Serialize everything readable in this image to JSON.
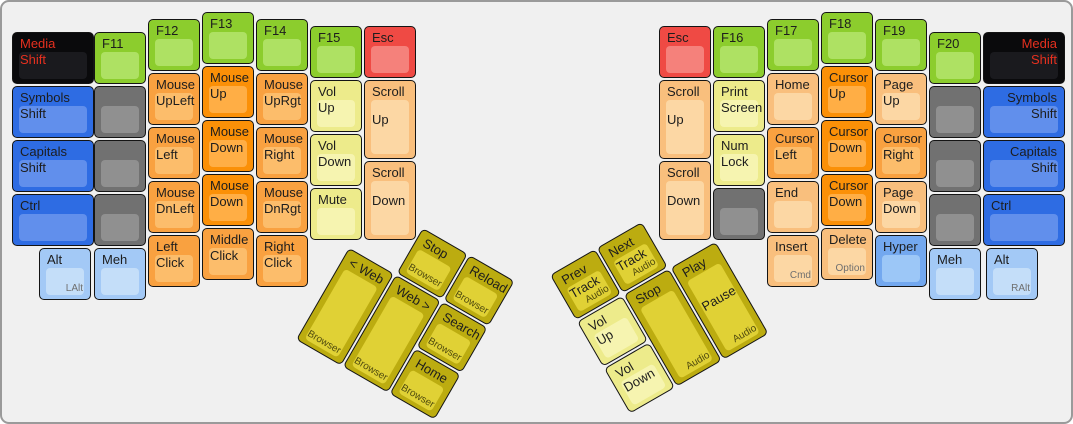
{
  "keyboard": {
    "description": "ErgoDox media/mouse layer keyboard layout",
    "frame": {
      "width": 1073,
      "height": 424,
      "background": "#f0f0f0",
      "border_color": "#9a9a9a"
    },
    "palette": {
      "black": {
        "base": "#0a0a0c",
        "top": "#1a1a1e",
        "text": "#e5301f"
      },
      "green": {
        "base": "#8ccd2d",
        "top": "#aee163"
      },
      "red": {
        "base": "#ef4a44",
        "top": "#f5817b"
      },
      "blue": {
        "base": "#2e6ce3",
        "top": "#618fec"
      },
      "hyper": {
        "base": "#73a8ef",
        "top": "#9cc7f7"
      },
      "lightblue": {
        "base": "#a3c9f6",
        "top": "#c4def9"
      },
      "gray": {
        "base": "#717171",
        "top": "#909090"
      },
      "orange": {
        "base": "#f9a140",
        "top": "#fcbd6b"
      },
      "orangeDeep": {
        "base": "#fb9007",
        "top": "#ffae45"
      },
      "peach": {
        "base": "#f9bf7d",
        "top": "#fcd7a4"
      },
      "paleYellow": {
        "base": "#edeb8b",
        "top": "#f6f4b0"
      },
      "mustard": {
        "base": "#bcac10",
        "top": "#e0d135"
      }
    },
    "keys": [
      {
        "name": "key-media-shift-left",
        "label": "Media\nShift",
        "color": "black",
        "x": 10,
        "y": 30,
        "w": 82
      },
      {
        "name": "key-f11",
        "label": "F11",
        "color": "green",
        "x": 92,
        "y": 30
      },
      {
        "name": "key-f12",
        "label": "F12",
        "color": "green",
        "x": 146,
        "y": 17
      },
      {
        "name": "key-f13",
        "label": "F13",
        "color": "green",
        "x": 200,
        "y": 10
      },
      {
        "name": "key-f14",
        "label": "F14",
        "color": "green",
        "x": 254,
        "y": 17
      },
      {
        "name": "key-f15",
        "label": "F15",
        "color": "green",
        "x": 308,
        "y": 24
      },
      {
        "name": "key-esc-left",
        "label": "Esc",
        "color": "red",
        "x": 362,
        "y": 24
      },
      {
        "name": "key-symbols-shift-left",
        "label": "Symbols\nShift",
        "color": "blue",
        "x": 10,
        "y": 84,
        "w": 82
      },
      {
        "name": "key-blank-left-1",
        "color": "gray",
        "x": 92,
        "y": 84
      },
      {
        "name": "key-mouse-upleft",
        "label": "Mouse\nUpLeft",
        "color": "orange",
        "x": 146,
        "y": 71
      },
      {
        "name": "key-mouse-up",
        "label": "Mouse\nUp",
        "color": "orangeDeep",
        "x": 200,
        "y": 64
      },
      {
        "name": "key-mouse-uprgt",
        "label": "Mouse\nUpRgt",
        "color": "orange",
        "x": 254,
        "y": 71
      },
      {
        "name": "key-vol-up-left",
        "label": "Vol\nUp",
        "color": "paleYellow",
        "x": 308,
        "y": 78
      },
      {
        "name": "key-scroll-up-left",
        "label": "Scroll",
        "label2": "Up",
        "color": "peach",
        "x": 362,
        "y": 78,
        "h": 79
      },
      {
        "name": "key-capitals-shift-left",
        "label": "Capitals\nShift",
        "color": "blue",
        "x": 10,
        "y": 138,
        "w": 82
      },
      {
        "name": "key-blank-left-2",
        "color": "gray",
        "x": 92,
        "y": 138
      },
      {
        "name": "key-mouse-left",
        "label": "Mouse\nLeft",
        "color": "orange",
        "x": 146,
        "y": 125
      },
      {
        "name": "key-mouse-down-mid",
        "label": "Mouse\nDown",
        "color": "orangeDeep",
        "x": 200,
        "y": 118
      },
      {
        "name": "key-mouse-right",
        "label": "Mouse\nRight",
        "color": "orange",
        "x": 254,
        "y": 125
      },
      {
        "name": "key-vol-down-left",
        "label": "Vol\nDown",
        "color": "paleYellow",
        "x": 308,
        "y": 132
      },
      {
        "name": "key-scroll-down-left",
        "label": "Scroll",
        "label2": "Down",
        "color": "peach",
        "x": 362,
        "y": 159,
        "h": 79
      },
      {
        "name": "key-ctrl-left",
        "label": "Ctrl",
        "color": "blue",
        "x": 10,
        "y": 192,
        "w": 82
      },
      {
        "name": "key-blank-left-3",
        "color": "gray",
        "x": 92,
        "y": 192
      },
      {
        "name": "key-mouse-dnleft",
        "label": "Mouse\nDnLeft",
        "color": "orange",
        "x": 146,
        "y": 179
      },
      {
        "name": "key-mouse-down-low",
        "label": "Mouse\nDown",
        "color": "orangeDeep",
        "x": 200,
        "y": 172
      },
      {
        "name": "key-mouse-dnrgt",
        "label": "Mouse\nDnRgt",
        "color": "orange",
        "x": 254,
        "y": 179
      },
      {
        "name": "key-mute",
        "label": "Mute",
        "color": "paleYellow",
        "x": 308,
        "y": 186
      },
      {
        "name": "key-alt-left",
        "label": "Alt",
        "sub": "LAlt",
        "color": "lightblue",
        "x": 37,
        "y": 246
      },
      {
        "name": "key-meh-left",
        "label": "Meh",
        "color": "lightblue",
        "x": 92,
        "y": 246
      },
      {
        "name": "key-left-click",
        "label": "Left\nClick",
        "color": "orange",
        "x": 146,
        "y": 233
      },
      {
        "name": "key-middle-click",
        "label": "Middle\nClick",
        "color": "orange",
        "x": 200,
        "y": 226
      },
      {
        "name": "key-right-click",
        "label": "Right\nClick",
        "color": "orange",
        "x": 254,
        "y": 233
      },
      {
        "name": "key-esc-right",
        "label": "Esc",
        "color": "red",
        "x": 657,
        "y": 24
      },
      {
        "name": "key-f16",
        "label": "F16",
        "color": "green",
        "x": 711,
        "y": 24
      },
      {
        "name": "key-f17",
        "label": "F17",
        "color": "green",
        "x": 765,
        "y": 17
      },
      {
        "name": "key-f18",
        "label": "F18",
        "color": "green",
        "x": 819,
        "y": 10
      },
      {
        "name": "key-f19",
        "label": "F19",
        "color": "green",
        "x": 873,
        "y": 17
      },
      {
        "name": "key-f20",
        "label": "F20",
        "color": "green",
        "x": 927,
        "y": 30
      },
      {
        "name": "key-media-shift-right",
        "label": "Media\nShift",
        "color": "black",
        "x": 981,
        "y": 30,
        "w": 82,
        "align": "right"
      },
      {
        "name": "key-scroll-up-right",
        "label": "Scroll",
        "label2": "Up",
        "color": "peach",
        "x": 657,
        "y": 78,
        "h": 79
      },
      {
        "name": "key-print-screen",
        "label": "Print\nScreen",
        "color": "paleYellow",
        "x": 711,
        "y": 78
      },
      {
        "name": "key-home",
        "label": "Home",
        "color": "peach",
        "x": 765,
        "y": 71
      },
      {
        "name": "key-cursor-up",
        "label": "Cursor\nUp",
        "color": "orangeDeep",
        "x": 819,
        "y": 64
      },
      {
        "name": "key-page-up",
        "label": "Page\nUp",
        "color": "peach",
        "x": 873,
        "y": 71
      },
      {
        "name": "key-blank-right-1",
        "color": "gray",
        "x": 927,
        "y": 84
      },
      {
        "name": "key-symbols-shift-right",
        "label": "Symbols\nShift",
        "color": "blue",
        "x": 981,
        "y": 84,
        "w": 82,
        "align": "right"
      },
      {
        "name": "key-scroll-down-right",
        "label": "Scroll",
        "label2": "Down",
        "color": "peach",
        "x": 657,
        "y": 159,
        "h": 79
      },
      {
        "name": "key-num-lock",
        "label": "Num\nLock",
        "color": "paleYellow",
        "x": 711,
        "y": 132
      },
      {
        "name": "key-cursor-left",
        "label": "Cursor\nLeft",
        "color": "orange",
        "x": 765,
        "y": 125
      },
      {
        "name": "key-cursor-down-mid",
        "label": "Cursor\nDown",
        "color": "orangeDeep",
        "x": 819,
        "y": 118
      },
      {
        "name": "key-cursor-right",
        "label": "Cursor\nRight",
        "color": "orange",
        "x": 873,
        "y": 125
      },
      {
        "name": "key-blank-right-2",
        "color": "gray",
        "x": 927,
        "y": 138
      },
      {
        "name": "key-capitals-shift-right",
        "label": "Capitals\nShift",
        "color": "blue",
        "x": 981,
        "y": 138,
        "w": 82,
        "align": "right"
      },
      {
        "name": "key-blank-right-3",
        "color": "gray",
        "x": 711,
        "y": 186
      },
      {
        "name": "key-end",
        "label": "End",
        "color": "peach",
        "x": 765,
        "y": 179
      },
      {
        "name": "key-cursor-down-low",
        "label": "Cursor\nDown",
        "color": "orangeDeep",
        "x": 819,
        "y": 172
      },
      {
        "name": "key-page-down",
        "label": "Page\nDown",
        "color": "peach",
        "x": 873,
        "y": 179
      },
      {
        "name": "key-blank-right-4",
        "color": "gray",
        "x": 927,
        "y": 192
      },
      {
        "name": "key-ctrl-right",
        "label": "Ctrl",
        "color": "blue",
        "x": 981,
        "y": 192,
        "w": 82
      },
      {
        "name": "key-insert",
        "label": "Insert",
        "sub": "Cmd",
        "color": "peach",
        "x": 765,
        "y": 233
      },
      {
        "name": "key-delete",
        "label": "Delete",
        "sub": "Option",
        "color": "peach",
        "x": 819,
        "y": 226
      },
      {
        "name": "key-hyper",
        "label": "Hyper",
        "color": "hyper",
        "x": 873,
        "y": 233
      },
      {
        "name": "key-meh-right",
        "label": "Meh",
        "color": "lightblue",
        "x": 927,
        "y": 246
      },
      {
        "name": "key-alt-right",
        "label": "Alt",
        "sub": "RAlt",
        "color": "lightblue",
        "x": 984,
        "y": 246
      }
    ],
    "thumb_clusters": {
      "left": {
        "x": 374,
        "y": 199,
        "rotation_deg": 30,
        "keys": [
          {
            "name": "key-stop-browser",
            "label": "Stop",
            "sub": "Browser",
            "color": "mustard",
            "x": 54,
            "y": 0
          },
          {
            "name": "key-reload",
            "label": "Reload",
            "sub": "Browser",
            "color": "mustard",
            "x": 108,
            "y": 0
          },
          {
            "name": "key-web-back",
            "label": "< Web",
            "sub": "Browser",
            "color": "mustard",
            "x": 0,
            "y": 54,
            "h": 106
          },
          {
            "name": "key-web-forward",
            "label": "Web >",
            "sub": "Browser",
            "color": "mustard",
            "x": 54,
            "y": 54,
            "h": 106
          },
          {
            "name": "key-search",
            "label": "Search",
            "sub": "Browser",
            "color": "mustard",
            "x": 108,
            "y": 54
          },
          {
            "name": "key-home-browser",
            "label": "Home",
            "sub": "Browser",
            "color": "mustard",
            "x": 108,
            "y": 108
          }
        ]
      },
      "right": {
        "x": 548,
        "y": 273,
        "rotation_deg": -30,
        "keys": [
          {
            "name": "key-prev-track",
            "label": "Prev\nTrack",
            "sub": "Audio",
            "color": "mustard",
            "x": 0,
            "y": 0
          },
          {
            "name": "key-next-track",
            "label": "Next\nTrack",
            "sub": "Audio",
            "color": "mustard",
            "x": 54,
            "y": 0
          },
          {
            "name": "key-vol-up-audio",
            "label": "Vol\nUp",
            "color": "paleYellow",
            "x": 0,
            "y": 54
          },
          {
            "name": "key-stop-audio",
            "label": "Stop",
            "sub": "Audio",
            "color": "mustard",
            "x": 54,
            "y": 54,
            "h": 106
          },
          {
            "name": "key-play-pause",
            "label": "Play",
            "label2": "Pause",
            "sub": "Audio",
            "color": "mustard",
            "x": 108,
            "y": 54,
            "h": 106
          },
          {
            "name": "key-vol-down-audio",
            "label": "Vol\nDown",
            "color": "paleYellow",
            "x": 0,
            "y": 108
          }
        ]
      }
    }
  }
}
